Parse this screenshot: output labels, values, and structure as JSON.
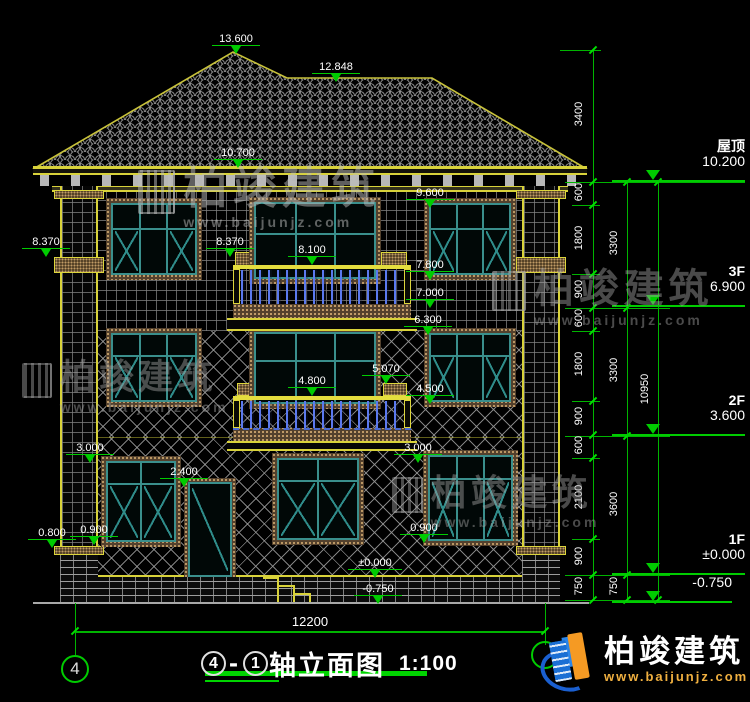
{
  "drawing": {
    "title_axis_start": "4",
    "title_separator": "-",
    "title_axis_end": "1",
    "title_text": "轴立面图",
    "scale": "1:100",
    "axis_bubble": "4"
  },
  "markers": [
    "13.600",
    "12.848",
    "10.700",
    "9.600",
    "8.370",
    "8.370",
    "8.100",
    "7.800",
    "7.000",
    "6.300",
    "5.070",
    "4.800",
    "4.500",
    "3.000",
    "2.400",
    "3.000",
    "0.800",
    "0.900",
    "0.900",
    "±0.000",
    "-0.750"
  ],
  "levels": {
    "roof": {
      "name": "屋顶",
      "value": "10.200"
    },
    "f3": {
      "name": "3F",
      "value": "6.900"
    },
    "f2": {
      "name": "2F",
      "value": "3.600"
    },
    "f1": {
      "name": "1F",
      "value": "±0.000"
    },
    "ground": {
      "value": "-0.750"
    }
  },
  "dimensions": {
    "right_inner": [
      "3400",
      "600",
      "1800",
      "900",
      "600",
      "1800",
      "900",
      "600",
      "2100",
      "900",
      "750"
    ],
    "right_mid": [
      "3300",
      "3300",
      "3600",
      "750"
    ],
    "right_outer": "10950",
    "bottom_width": "12200"
  },
  "watermark": {
    "name": "柏竣建筑",
    "url": "www.baijunjz.com"
  },
  "logo": {
    "name": "柏竣建筑",
    "url": "www.baijunjz.com"
  },
  "colors": {
    "dimension_green": "#00c800",
    "cad_yellow": "#d8d23a",
    "window_teal": "#2e7f7f",
    "baluster_blue": "#5b79ef",
    "logo_blue": "#1a6fd4",
    "logo_orange": "#f59a23"
  }
}
